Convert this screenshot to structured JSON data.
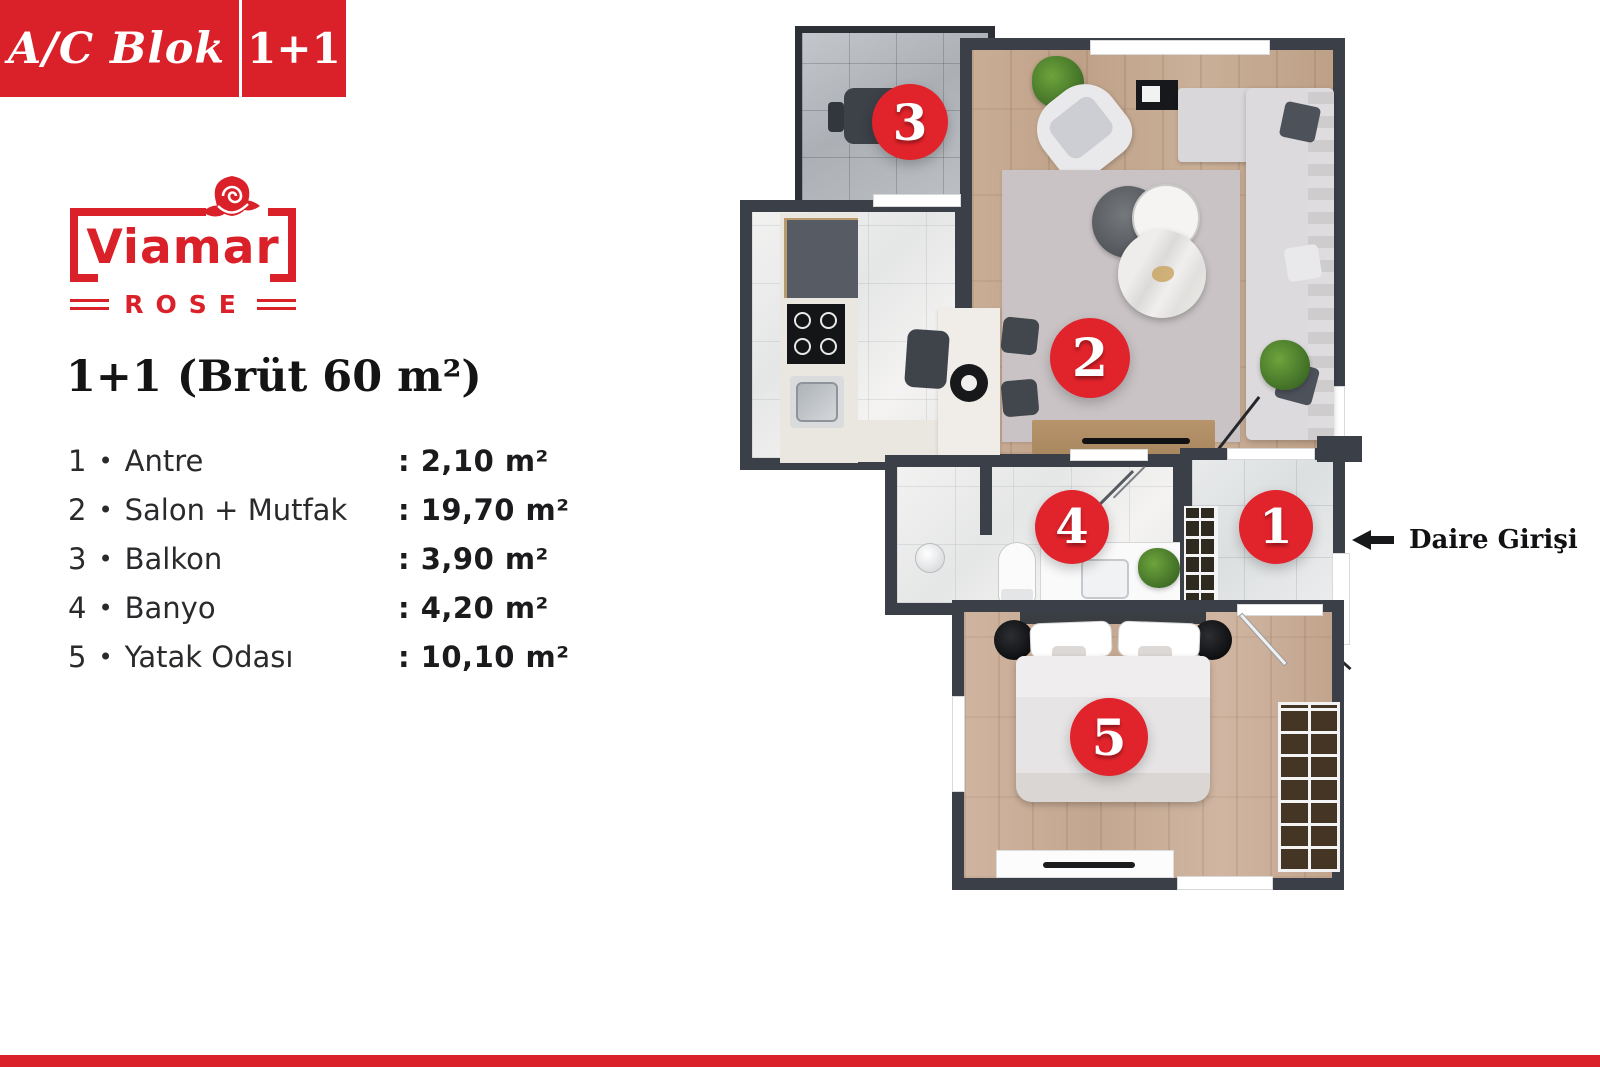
{
  "badge": {
    "block_label": "A/C Blok",
    "unit_label": "1+1"
  },
  "logo": {
    "brand": "Viamar",
    "sub_brand": "ROSE"
  },
  "plan_title": "1+1 (Brüt 60 m²)",
  "separator": "•",
  "rooms": [
    {
      "num": "1",
      "name": "Antre",
      "area": ": 2,10 m²"
    },
    {
      "num": "2",
      "name": "Salon + Mutfak",
      "area": ": 19,70 m²"
    },
    {
      "num": "3",
      "name": "Balkon",
      "area": ": 3,90 m²"
    },
    {
      "num": "4",
      "name": "Banyo",
      "area": ": 4,20 m²"
    },
    {
      "num": "5",
      "name": "Yatak Odası",
      "area": ": 10,10 m²"
    }
  ],
  "entrance": {
    "label": "Daire Girişi"
  },
  "colors": {
    "accent_red": "#da2129",
    "marker_red": "#e1232b",
    "wall_dark": "#3b3f48"
  }
}
